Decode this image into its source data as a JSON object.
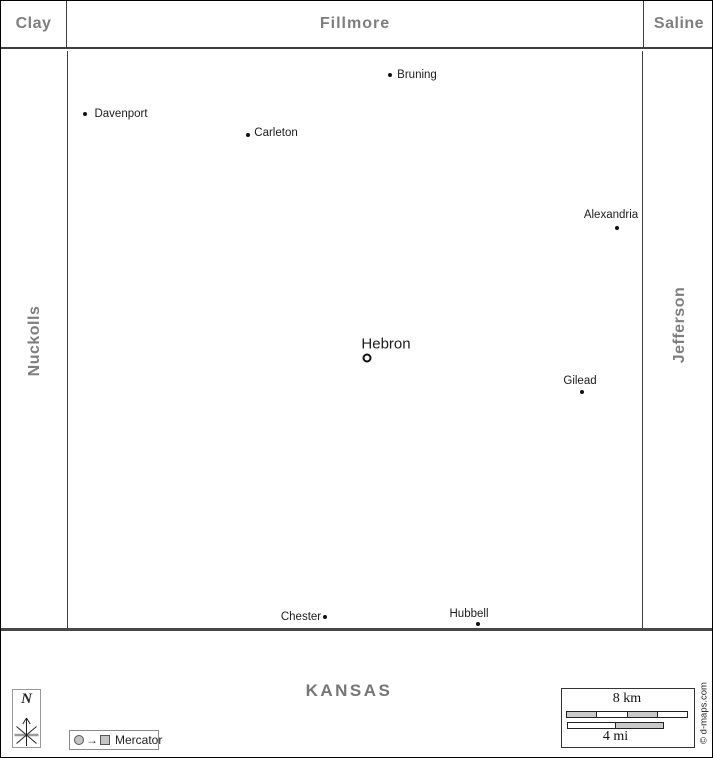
{
  "neighbors": {
    "top": [
      {
        "id": "clay",
        "label": "Clay"
      },
      {
        "id": "fillmore",
        "label": "Fillmore"
      },
      {
        "id": "saline",
        "label": "Saline"
      }
    ],
    "left": {
      "id": "nuckolls",
      "label": "Nuckolls"
    },
    "right": {
      "id": "jefferson",
      "label": "Jefferson"
    },
    "bottom": {
      "id": "kansas",
      "label": "KANSAS"
    }
  },
  "towns": [
    {
      "name": "Bruning",
      "seat": false,
      "dot": {
        "x": 389,
        "y": 74
      },
      "label": {
        "x": 416,
        "y": 74
      }
    },
    {
      "name": "Davenport",
      "seat": false,
      "dot": {
        "x": 84,
        "y": 113
      },
      "label": {
        "x": 120,
        "y": 113
      }
    },
    {
      "name": "Carleton",
      "seat": false,
      "dot": {
        "x": 247,
        "y": 134
      },
      "label": {
        "x": 275,
        "y": 132
      }
    },
    {
      "name": "Alexandria",
      "seat": false,
      "dot": {
        "x": 616,
        "y": 227
      },
      "label": {
        "x": 610,
        "y": 214
      }
    },
    {
      "name": "Hebron",
      "seat": true,
      "dot": {
        "x": 366,
        "y": 357
      },
      "label": {
        "x": 385,
        "y": 343
      }
    },
    {
      "name": "Gilead",
      "seat": false,
      "dot": {
        "x": 581,
        "y": 391
      },
      "label": {
        "x": 579,
        "y": 380
      }
    },
    {
      "name": "Chester",
      "seat": false,
      "dot": {
        "x": 324,
        "y": 616
      },
      "label": {
        "x": 300,
        "y": 616
      }
    },
    {
      "name": "Hubbell",
      "seat": false,
      "dot": {
        "x": 477,
        "y": 623
      },
      "label": {
        "x": 468,
        "y": 613
      }
    }
  ],
  "north_indicator": {
    "label": "N"
  },
  "projection_legend": {
    "label": "Mercator",
    "arrow": "→"
  },
  "scale_bar": {
    "km_label": "8 km",
    "mi_label": "4 mi",
    "km_segments": [
      "#c9c9c9",
      "#ffffff",
      "#c9c9c9",
      "#ffffff"
    ],
    "mi_segments": [
      "#ffffff",
      "#c9c9c9"
    ]
  },
  "credit": "© d-maps.com",
  "colors": {
    "region_label": "#7e7e7e",
    "town_label": "#1c1c1c",
    "border_line": "#3f3f3f",
    "scale_gray": "#c9c9c9"
  }
}
